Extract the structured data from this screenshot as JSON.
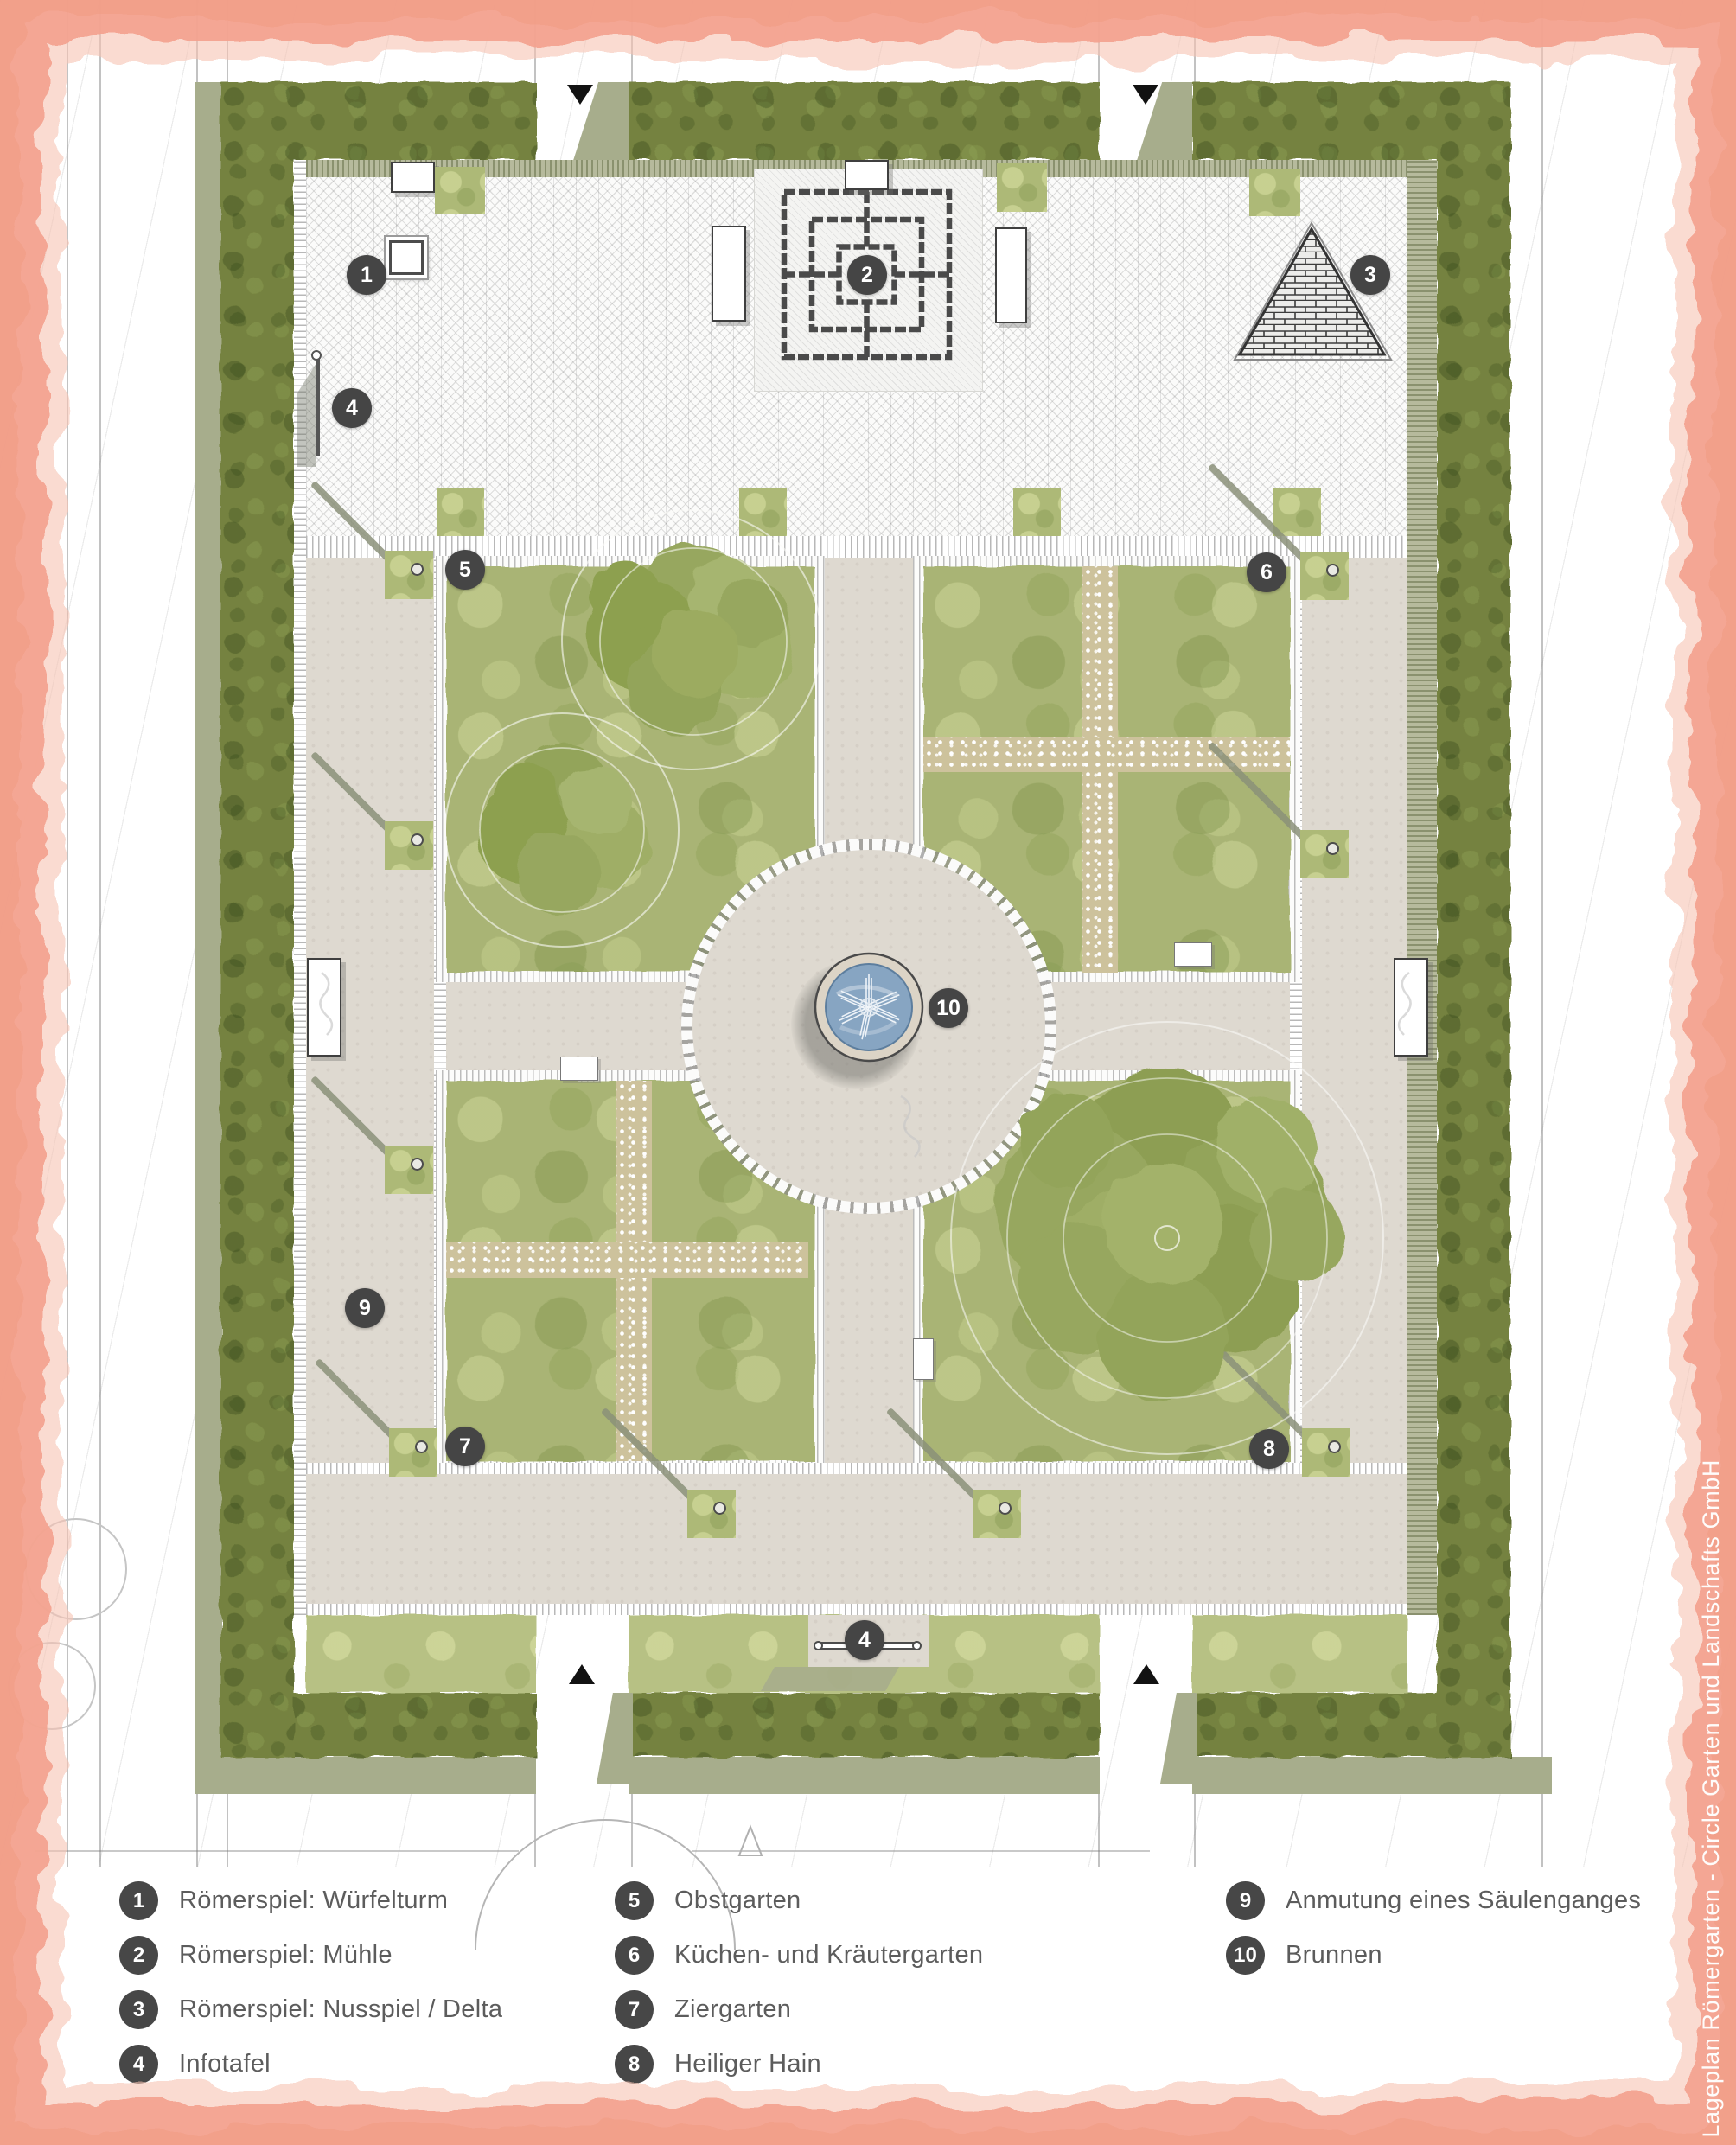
{
  "credit": {
    "text": "Lageplan Römergarten - Circle Garten und Landschafts GmbH"
  },
  "legend": {
    "items": [
      {
        "number": "1",
        "label": "Römerspiel: Würfelturm"
      },
      {
        "number": "2",
        "label": "Römerspiel: Mühle"
      },
      {
        "number": "3",
        "label": "Römerspiel: Nusspiel / Delta"
      },
      {
        "number": "4",
        "label": "Infotafel"
      },
      {
        "number": "5",
        "label": "Obstgarten"
      },
      {
        "number": "6",
        "label": "Küchen- und Kräutergarten"
      },
      {
        "number": "7",
        "label": "Ziergarten"
      },
      {
        "number": "8",
        "label": "Heiliger Hain"
      },
      {
        "number": "9",
        "label": "Anmutung eines Säulenganges"
      },
      {
        "number": "10",
        "label": "Brunnen"
      }
    ]
  },
  "plan": {
    "markers": [
      {
        "number": "1"
      },
      {
        "number": "2"
      },
      {
        "number": "3"
      },
      {
        "number": "4"
      },
      {
        "number": "5"
      },
      {
        "number": "6"
      },
      {
        "number": "7"
      },
      {
        "number": "8"
      },
      {
        "number": "9"
      },
      {
        "number": "10"
      },
      {
        "number": "4"
      }
    ]
  },
  "colors": {
    "border_pink": "#f3a28f",
    "hedge_dark": "#75823f",
    "lawn_light": "#b7c184",
    "bed_green": "#a9b474",
    "path_beige": "#ded9d0",
    "gravel": "#cdc29c",
    "water_blue": "#87a5c2",
    "olive_shadow": "#a7ad8c",
    "marker_dark": "#454545"
  }
}
